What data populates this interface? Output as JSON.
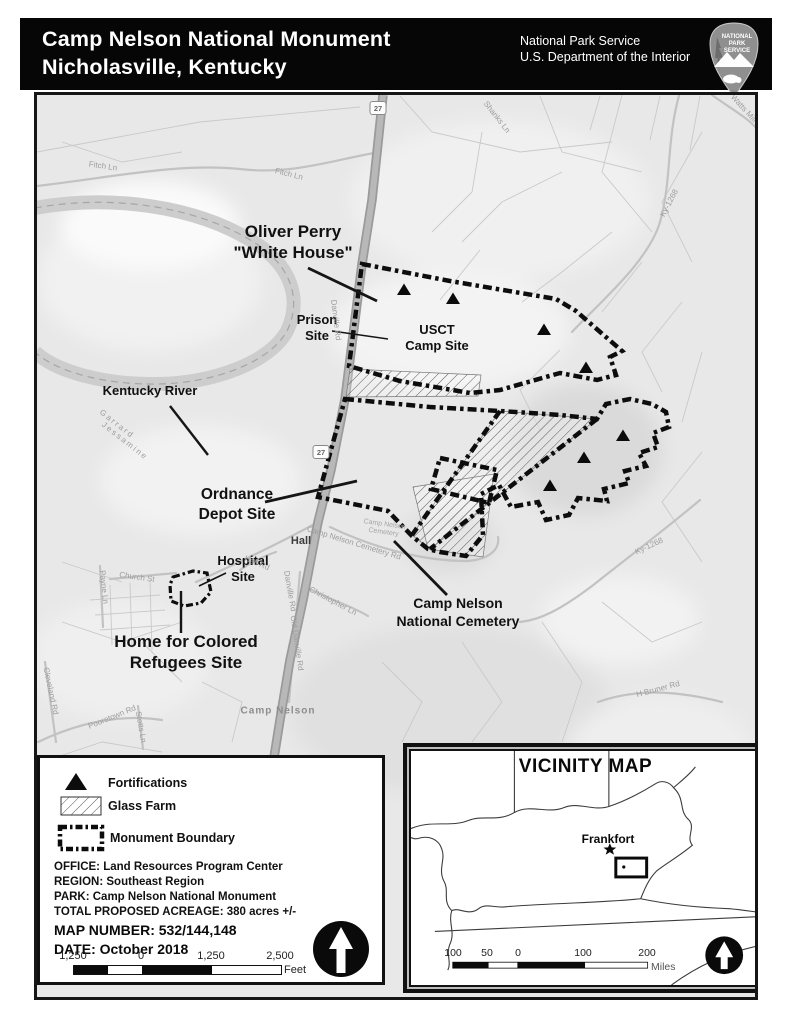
{
  "header": {
    "title_line1": "Camp Nelson National Monument",
    "title_line2": "Nicholasville, Kentucky",
    "agency_line1": "National Park Service",
    "agency_line2": "U.S. Department of the Interior",
    "logo_text_1": "NATIONAL",
    "logo_text_2": "PARK",
    "logo_text_3": "SERVICE"
  },
  "map": {
    "labels": [
      {
        "id": "oliver-perry-white-house",
        "text": "Oliver Perry\n\"White House\"",
        "x": 293,
        "y": 242,
        "rot": 0,
        "cls": "lg"
      },
      {
        "id": "prison-site",
        "text": "Prison\nSite",
        "x": 317,
        "y": 328,
        "rot": 0,
        "cls": "md"
      },
      {
        "id": "usct-camp-site",
        "text": "USCT\nCamp Site",
        "x": 437,
        "y": 338,
        "rot": 0,
        "cls": "md"
      },
      {
        "id": "kentucky-river",
        "text": "Kentucky River",
        "x": 150,
        "y": 391,
        "rot": 0,
        "cls": "md"
      },
      {
        "id": "ordnance-depot-site",
        "text": "Ordnance\nDepot Site",
        "x": 237,
        "y": 505,
        "rot": 0,
        "cls": "lg2"
      },
      {
        "id": "hospital-site",
        "text": "Hospital\nSite",
        "x": 243,
        "y": 569,
        "rot": 0,
        "cls": "md"
      },
      {
        "id": "home-for-colored-refugees-site",
        "text": "Home for Colored\nRefugees Site",
        "x": 186,
        "y": 652,
        "rot": 0,
        "cls": "lg"
      },
      {
        "id": "camp-nelson-national-cemetery",
        "text": "Camp Nelson\nNational Cemetery",
        "x": 458,
        "y": 612,
        "rot": 0,
        "cls": "md2"
      },
      {
        "id": "hall",
        "text": "Hall",
        "x": 301,
        "y": 541,
        "rot": 0,
        "cls": "place"
      },
      {
        "id": "camp-nelson-town",
        "text": "Camp Nelson",
        "x": 278,
        "y": 711,
        "rot": 0,
        "cls": "town"
      },
      {
        "id": "garrard-county",
        "text": "Garrard",
        "x": 117,
        "y": 424,
        "rot": 38,
        "cls": "county"
      },
      {
        "id": "jessamine-county",
        "text": "Jessamine",
        "x": 125,
        "y": 441,
        "rot": 38,
        "cls": "county"
      },
      {
        "id": "fitch-ln-west",
        "text": "Fitch Ln",
        "x": 103,
        "y": 166,
        "rot": 8,
        "cls": "road"
      },
      {
        "id": "fitch-ln-east",
        "text": "Fitch Ln",
        "x": 289,
        "y": 174,
        "rot": 14,
        "cls": "road"
      },
      {
        "id": "shanks-ln",
        "text": "Shanks Ln",
        "x": 497,
        "y": 117,
        "rot": 52,
        "cls": "road"
      },
      {
        "id": "watts-mill-rd",
        "text": "Watts Mill Rd",
        "x": 748,
        "y": 113,
        "rot": 48,
        "cls": "road"
      },
      {
        "id": "ky-1268-north",
        "text": "Ky-1268",
        "x": 669,
        "y": 203,
        "rot": -62,
        "cls": "road"
      },
      {
        "id": "ky-1268-south",
        "text": "Ky-1268",
        "x": 649,
        "y": 546,
        "rot": -25,
        "cls": "road"
      },
      {
        "id": "danville-rd-north",
        "text": "Danville Rd",
        "x": 336,
        "y": 320,
        "rot": 83,
        "cls": "road"
      },
      {
        "id": "danville-rd-south",
        "text": "Danville Rd",
        "x": 290,
        "y": 591,
        "rot": 80,
        "cls": "road"
      },
      {
        "id": "old-danville-rd",
        "text": "Old Danville Rd",
        "x": 297,
        "y": 643,
        "rot": 82,
        "cls": "road"
      },
      {
        "id": "camp-nelson-cemetery-rd",
        "text": "Camp Nelson Cemetery Rd",
        "x": 354,
        "y": 543,
        "rot": 17,
        "cls": "road"
      },
      {
        "id": "camp-nelson-cemetery",
        "text": "Camp Nelson\nCemetery",
        "x": 384,
        "y": 529,
        "rot": 8,
        "cls": "roadsm"
      },
      {
        "id": "hall-rd",
        "text": "Hall Rd",
        "x": 257,
        "y": 563,
        "rot": 22,
        "cls": "road"
      },
      {
        "id": "christopher-ln",
        "text": "Christopher Ln",
        "x": 333,
        "y": 601,
        "rot": 28,
        "cls": "road"
      },
      {
        "id": "payne-ln",
        "text": "Payne Ln",
        "x": 104,
        "y": 587,
        "rot": 84,
        "cls": "road"
      },
      {
        "id": "church-st",
        "text": "Church St",
        "x": 137,
        "y": 577,
        "rot": 8,
        "cls": "road"
      },
      {
        "id": "pooretown-rd",
        "text": "Pooretown Rd",
        "x": 112,
        "y": 717,
        "rot": -22,
        "cls": "road"
      },
      {
        "id": "stotts-ln",
        "text": "Stotts Ln",
        "x": 141,
        "y": 727,
        "rot": 80,
        "cls": "road"
      },
      {
        "id": "cleveland-rd",
        "text": "Cleveland Rd",
        "x": 51,
        "y": 691,
        "rot": 78,
        "cls": "road"
      },
      {
        "id": "h-bruner-rd",
        "text": "H Bruner Rd",
        "x": 658,
        "y": 689,
        "rot": -15,
        "cls": "road"
      }
    ],
    "route_shields": [
      {
        "num": "27",
        "x": 378,
        "y": 108
      },
      {
        "num": "27",
        "x": 321,
        "y": 452
      }
    ],
    "fortifications": [
      [
        404,
        290
      ],
      [
        453,
        299
      ],
      [
        544,
        330
      ],
      [
        586,
        368
      ],
      [
        623,
        436
      ],
      [
        584,
        458
      ],
      [
        550,
        486
      ]
    ]
  },
  "legend": {
    "items": [
      {
        "symbol": "fortification-triangle",
        "label": "Fortifications"
      },
      {
        "symbol": "diagonal-hatch-swatch",
        "label": "Glass Farm"
      },
      {
        "symbol": "dash-dot-boundary-swatch",
        "label": "Monument Boundary"
      }
    ],
    "info_lines": [
      "OFFICE: Land Resources Program Center",
      "REGION: Southeast Region",
      "PARK: Camp Nelson National Monument",
      "TOTAL PROPOSED ACREAGE: 380 acres +/-"
    ],
    "map_number_line": "MAP NUMBER: 532/144,148",
    "date_line": "DATE: October 2018",
    "scale": {
      "labels": [
        "1,250",
        "0",
        "1,250",
        "2,500"
      ],
      "unit": "Feet"
    }
  },
  "vicinity": {
    "title": "VICINITY MAP",
    "capital_label": "Frankfort",
    "scale": {
      "labels": [
        "100",
        "50",
        "0",
        "100",
        "200"
      ],
      "unit": "Miles"
    }
  }
}
